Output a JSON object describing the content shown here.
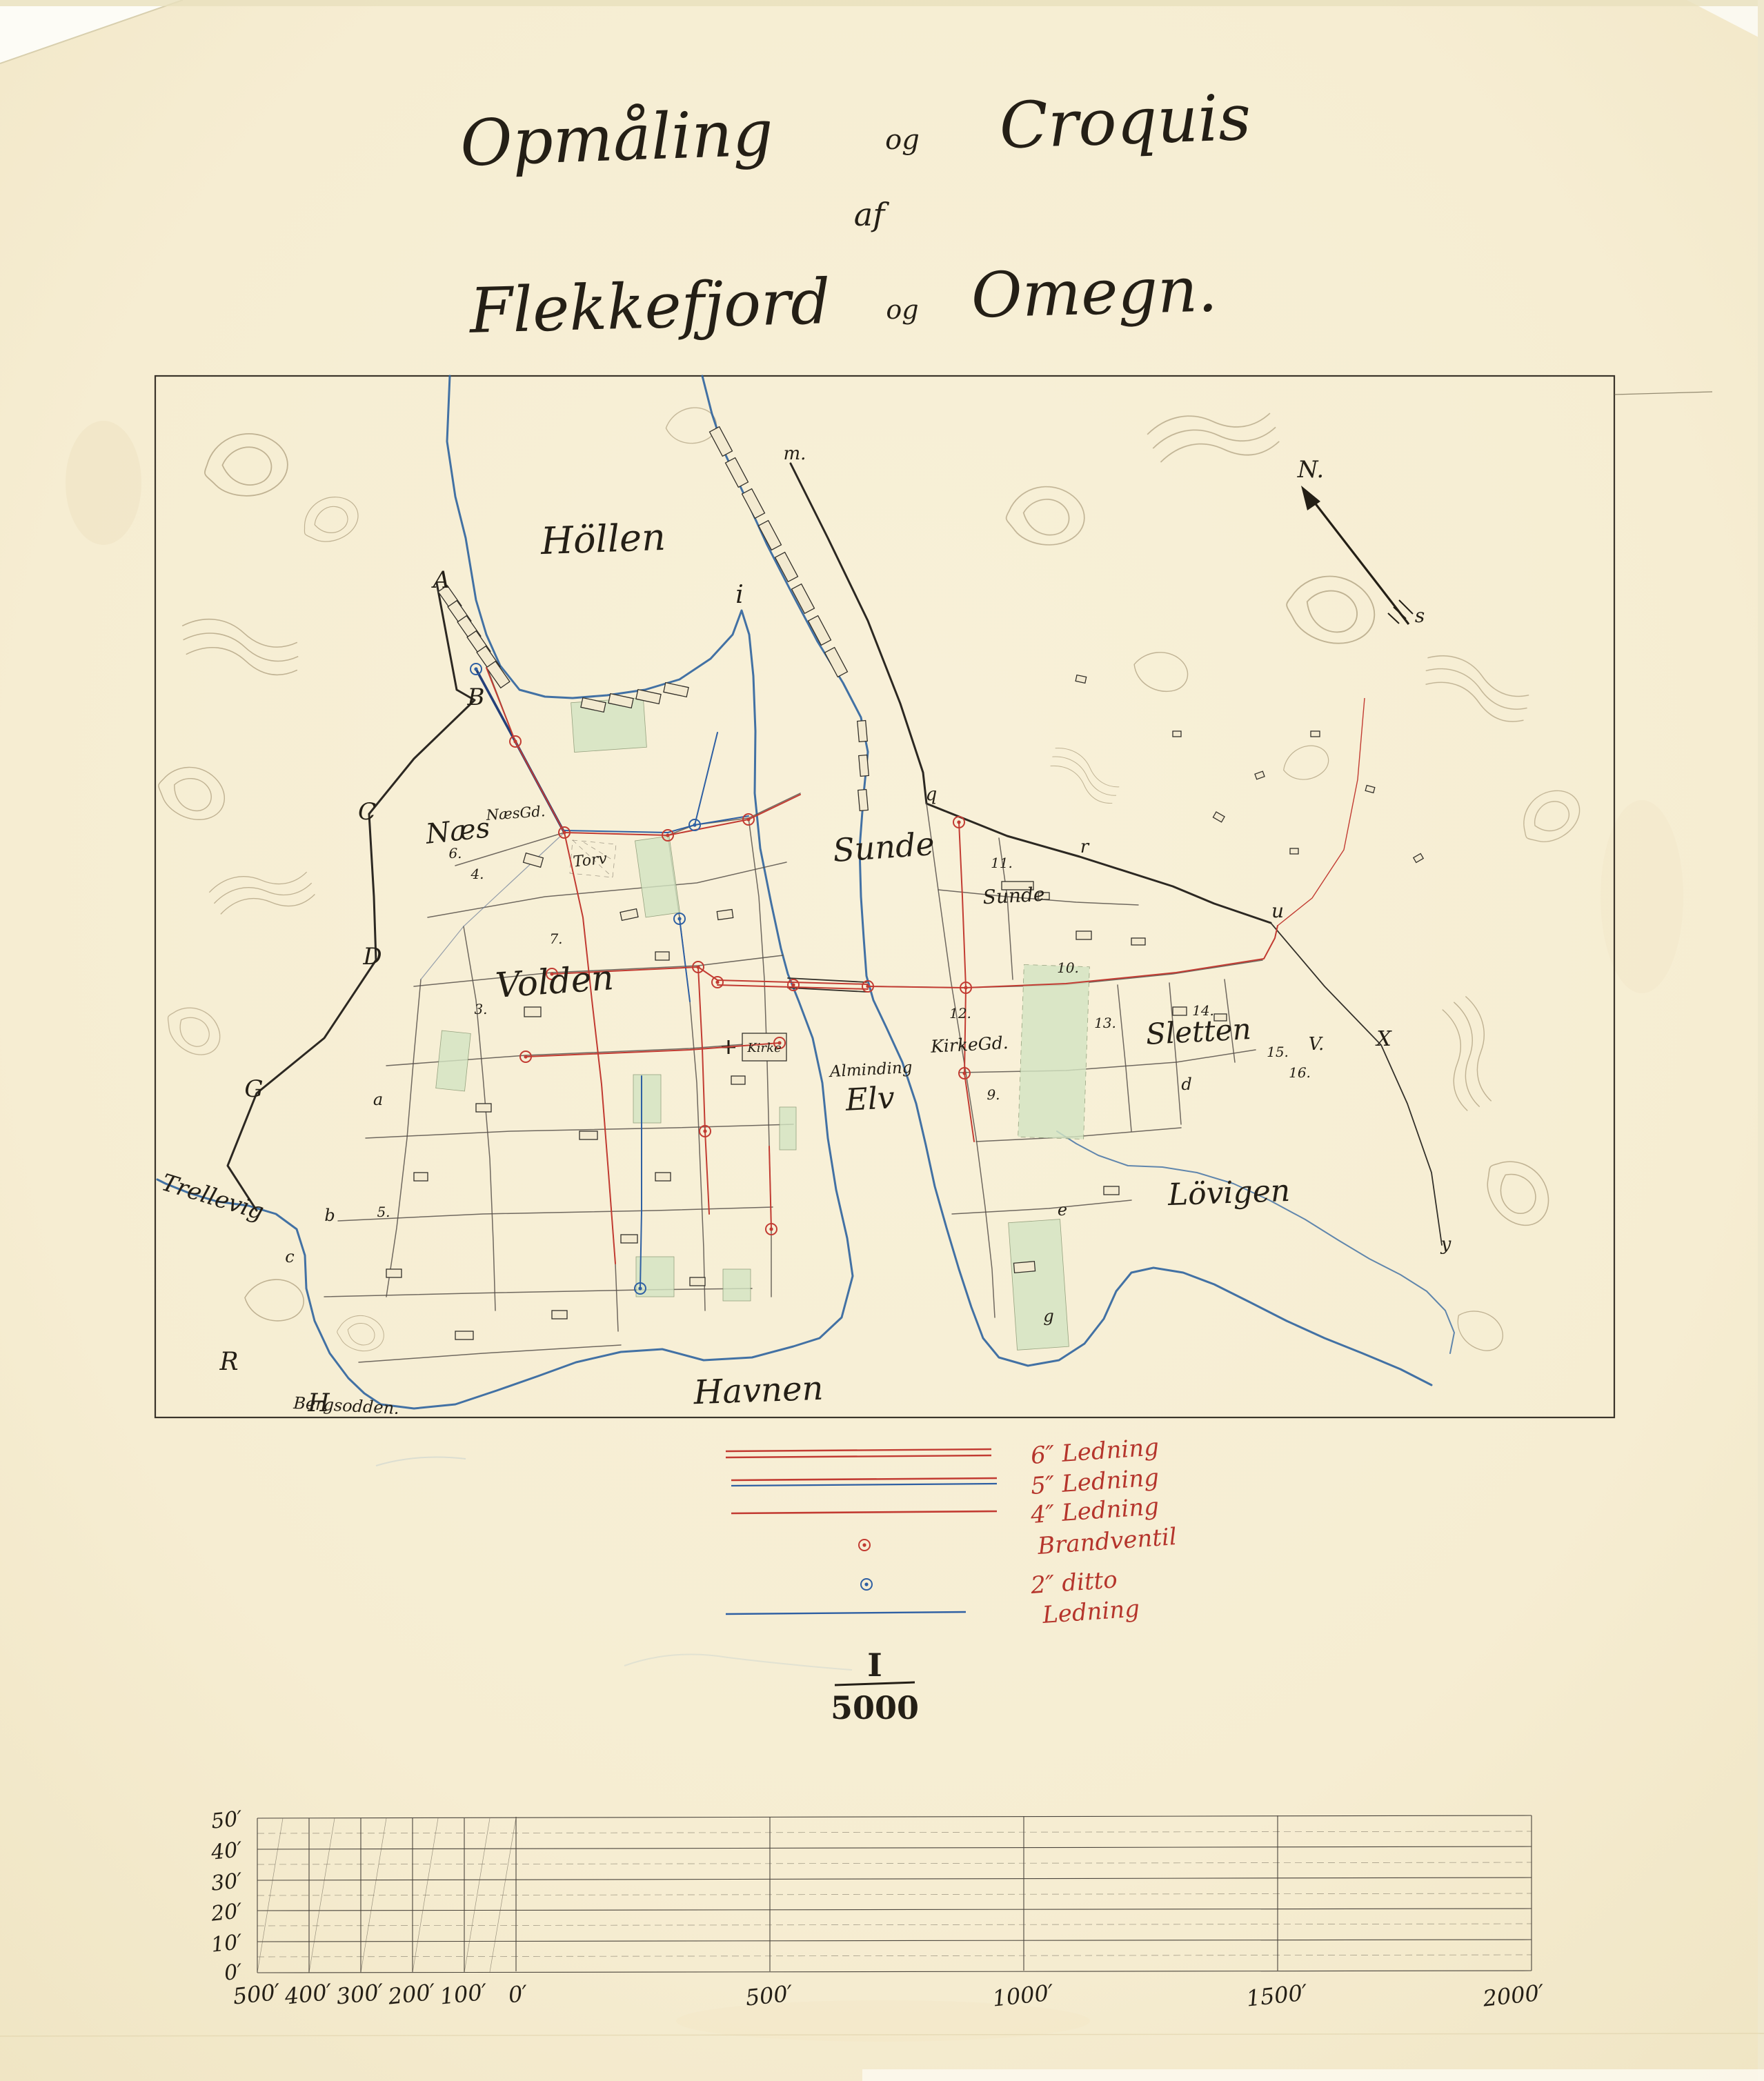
{
  "title": {
    "word1": "Opmåling",
    "conj1": "og",
    "word2": "Croquis",
    "line2": "af",
    "word3": "Flekkefjord",
    "conj2": "og",
    "word4": "Omegn."
  },
  "map": {
    "places": {
      "hollen": "Höllen",
      "naes": "Næs",
      "naes_gaard": "NæsGd.",
      "torv": "Torv",
      "volden": "Volden",
      "kirke": "Kirke",
      "sunde_district": "Sunde",
      "sunde_farm": "Sunde",
      "alminding": "Alminding",
      "elv": "Elv",
      "kirkegaard": "KirkeGd.",
      "sletten": "Sletten",
      "lovigen": "Lövigen",
      "havnen": "Havnen",
      "trellevig": "Trellevig",
      "bergsodden": "Bergsodden."
    },
    "points": {
      "A": "A",
      "B": "B",
      "C": "C",
      "D": "D",
      "G": "G",
      "R": "R",
      "H": "H",
      "i": "i",
      "m": "m.",
      "q": "q",
      "r": "r",
      "u": "u",
      "V": "V.",
      "X": "X",
      "y": "y",
      "s": "s",
      "north": "N."
    },
    "lots": {
      "a": "a",
      "b": "b",
      "c": "c",
      "d": "d",
      "e": "e",
      "g": "g"
    },
    "numbers": {
      "n3": "3.",
      "n4": "4.",
      "n5": "5.",
      "n6": "6.",
      "n7": "7.",
      "n9": "9.",
      "n10": "10.",
      "n11": "11.",
      "n12": "12.",
      "n13": "13.",
      "n14": "14.",
      "n15": "15.",
      "n16": "16."
    }
  },
  "legend": {
    "items": [
      {
        "symbol": "line-red-double",
        "label": "6″ Ledning"
      },
      {
        "symbol": "line-red-over-blue",
        "label": "5″ Ledning"
      },
      {
        "symbol": "line-red",
        "label": "4″ Ledning"
      },
      {
        "symbol": "valve-red",
        "label": "Brandventil"
      },
      {
        "symbol": "valve-blue",
        "label": "2″ ditto"
      },
      {
        "symbol": "line-blue",
        "label": "Ledning"
      }
    ],
    "text_color": "#b5352c"
  },
  "scale_ratio": {
    "numerator": "I",
    "denominator": "5000"
  },
  "profile_scale": {
    "y_ticks": [
      "50′",
      "40′",
      "30′",
      "20′",
      "10′",
      "0′"
    ],
    "left_ticks": [
      "500′",
      "400′",
      "300′",
      "200′",
      "100′",
      "0′"
    ],
    "right_ticks": [
      "500′",
      "1000′",
      "1500′",
      "2000′"
    ]
  },
  "colors": {
    "paper": "#f6edd2",
    "ink": "#241f16",
    "water_blue": "#2e639f",
    "pipe_red": "#c23b32",
    "pipe_blue": "#2e5fa3",
    "garden_green": "#d3e4c2",
    "legend_red": "#b5352c",
    "contour": "#9b8a68"
  }
}
